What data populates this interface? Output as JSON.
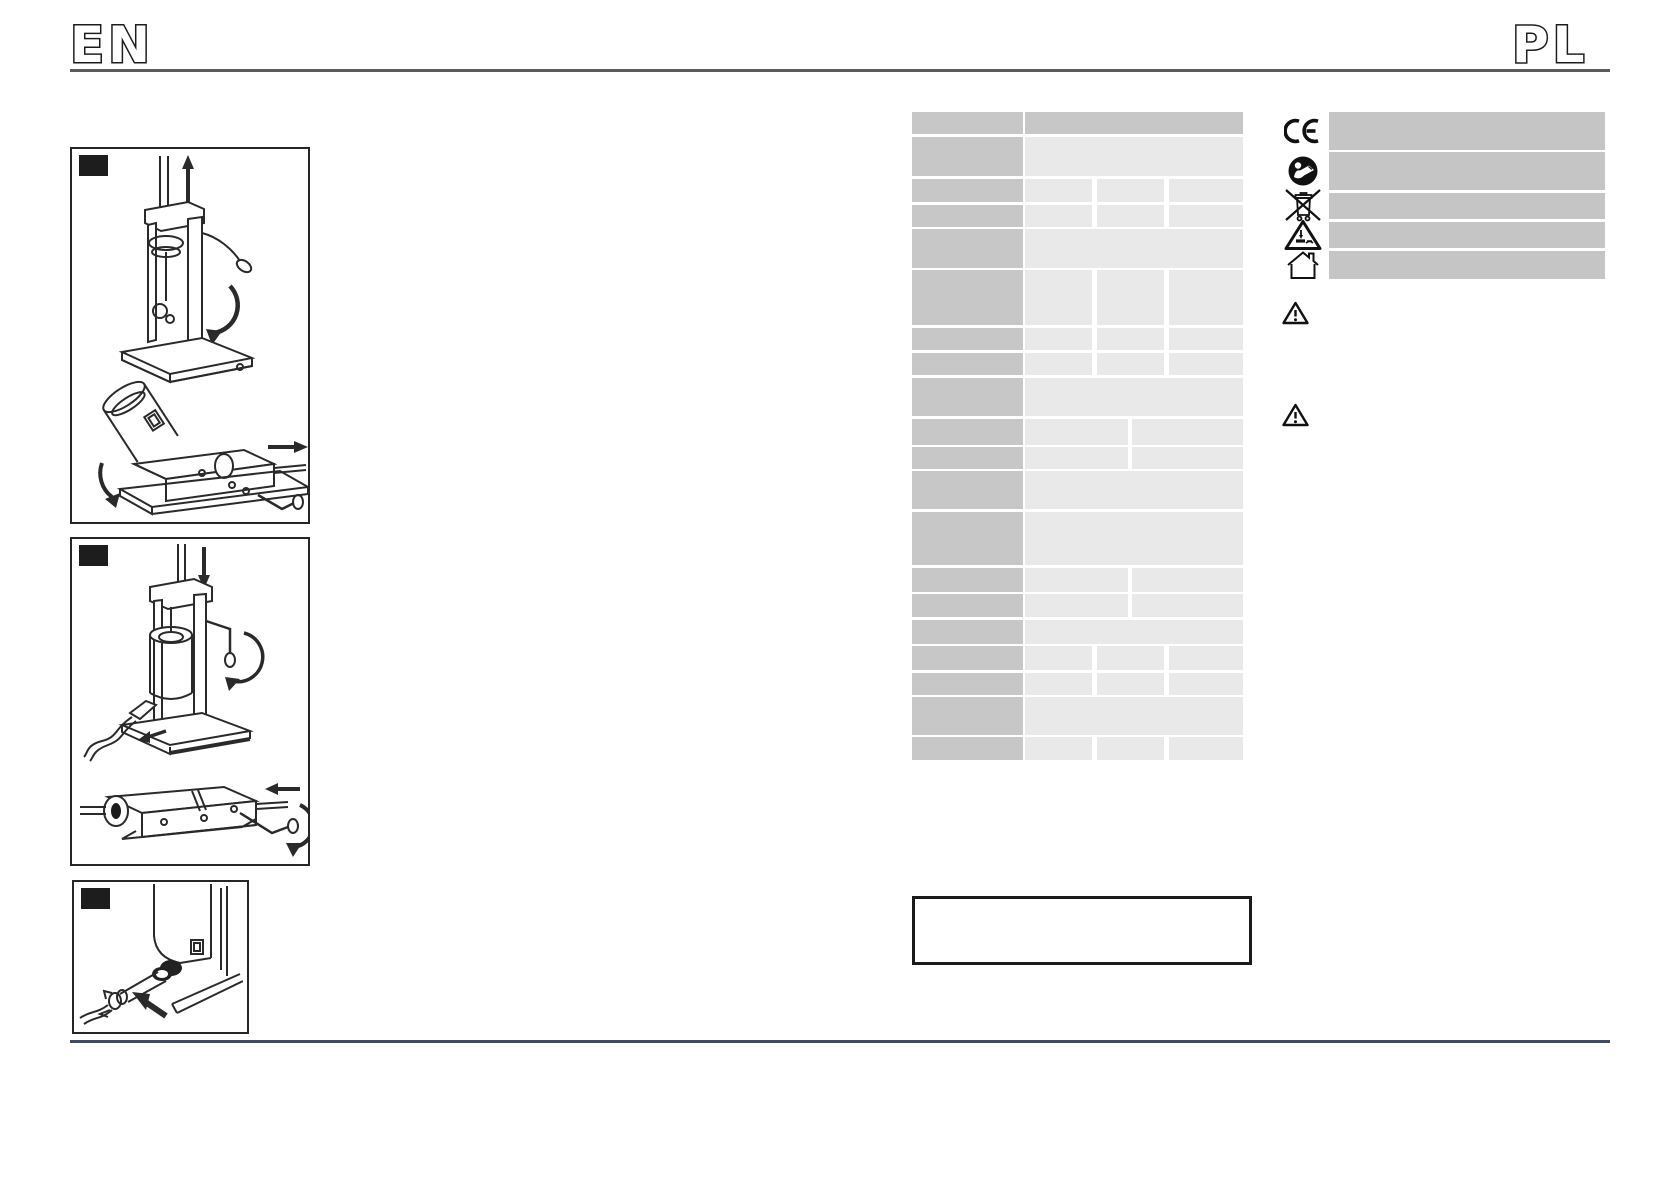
{
  "header": {
    "lang_left": "EN",
    "lang_right": "PL"
  },
  "colors": {
    "table_label_gray": "#c7c7c7",
    "table_value_gray": "#e9e9e9",
    "symbol_bar_gray": "#c5c5c5",
    "rule_top": "#5c5c5c",
    "rule_bottom": "#3e4a66",
    "ink": "#262626",
    "label_square": "#1d1d1d"
  },
  "figures": [
    {
      "name": "figure-vertical-stuffer-assembly",
      "label": "",
      "content": "vertical sausage stuffer with piston raised (up arrow) and tilted cylinder removal from horizontal body (right arrow, crank)"
    },
    {
      "name": "figure-vertical-stuffer-operation",
      "label": "",
      "content": "vertical sausage stuffer with piston pressed down (down arrow, crank rotation) and horizontal stuffer with rod (left arrow, crank rotation)"
    },
    {
      "name": "figure-nozzle-closeup",
      "label": "",
      "content": "close-up of stuffing tube nozzle with casing and arrow"
    }
  ],
  "spec_table": {
    "x": 912,
    "y": 112,
    "width": 331,
    "label_col": {
      "x": 0,
      "w": 111
    },
    "value_area": {
      "x": 113,
      "w": 218
    },
    "col_layouts": {
      "1": [
        {
          "x": 113,
          "w": 218
        }
      ],
      "2": [
        {
          "x": 113,
          "w": 103
        },
        {
          "x": 220,
          "w": 111
        }
      ],
      "3": [
        {
          "x": 113,
          "w": 67
        },
        {
          "x": 185,
          "w": 67
        },
        {
          "x": 257,
          "w": 74
        }
      ]
    },
    "rows": [
      {
        "y": 112,
        "h": 22,
        "cols": 1,
        "header": true,
        "label": "",
        "values": [
          ""
        ]
      },
      {
        "y": 137,
        "h": 39,
        "cols": 1,
        "header": false,
        "label": "",
        "values": [
          ""
        ]
      },
      {
        "y": 179,
        "h": 23,
        "cols": 3,
        "header": false,
        "label": "",
        "values": [
          "",
          "",
          ""
        ]
      },
      {
        "y": 205,
        "h": 22,
        "cols": 3,
        "header": false,
        "label": "",
        "values": [
          "",
          "",
          ""
        ]
      },
      {
        "y": 229,
        "h": 39,
        "cols": 1,
        "header": false,
        "label": "",
        "values": [
          ""
        ]
      },
      {
        "y": 270,
        "h": 55,
        "cols": 3,
        "header": false,
        "label": "",
        "values": [
          "",
          "",
          ""
        ]
      },
      {
        "y": 328,
        "h": 22,
        "cols": 3,
        "header": false,
        "label": "",
        "values": [
          "",
          "",
          ""
        ]
      },
      {
        "y": 353,
        "h": 22,
        "cols": 3,
        "header": false,
        "label": "",
        "values": [
          "",
          "",
          ""
        ]
      },
      {
        "y": 378,
        "h": 38,
        "cols": 1,
        "header": false,
        "label": "",
        "values": [
          ""
        ]
      },
      {
        "y": 419,
        "h": 26,
        "cols": 2,
        "header": false,
        "label": "",
        "values": [
          "",
          ""
        ]
      },
      {
        "y": 447,
        "h": 22,
        "cols": 2,
        "header": false,
        "label": "",
        "values": [
          "",
          ""
        ]
      },
      {
        "y": 471,
        "h": 38,
        "cols": 1,
        "header": false,
        "label": "",
        "values": [
          ""
        ]
      },
      {
        "y": 512,
        "h": 53,
        "cols": 1,
        "header": false,
        "label": "",
        "values": [
          ""
        ]
      },
      {
        "y": 568,
        "h": 24,
        "cols": 2,
        "header": false,
        "label": "",
        "values": [
          "",
          ""
        ]
      },
      {
        "y": 594,
        "h": 23,
        "cols": 2,
        "header": false,
        "label": "",
        "values": [
          "",
          ""
        ]
      },
      {
        "y": 620,
        "h": 24,
        "cols": 1,
        "header": false,
        "label": "",
        "values": [
          ""
        ]
      },
      {
        "y": 646,
        "h": 24,
        "cols": 3,
        "header": false,
        "label": "",
        "values": [
          "",
          "",
          ""
        ]
      },
      {
        "y": 673,
        "h": 22,
        "cols": 3,
        "header": false,
        "label": "",
        "values": [
          "",
          "",
          ""
        ]
      },
      {
        "y": 697,
        "h": 38,
        "cols": 1,
        "header": false,
        "label": "",
        "values": [
          ""
        ]
      },
      {
        "y": 737,
        "h": 23,
        "cols": 3,
        "header": false,
        "label": "",
        "values": [
          "",
          "",
          ""
        ]
      }
    ]
  },
  "symbols": {
    "bar_x": 1329,
    "bar_w": 276,
    "icon_x": 1284,
    "items": [
      {
        "name": "ce-mark-icon",
        "bar_y": 112,
        "bar_h": 38,
        "text": ""
      },
      {
        "name": "read-manual-icon",
        "bar_y": 152,
        "bar_h": 38,
        "text": ""
      },
      {
        "name": "weee-crossed-bin-icon",
        "bar_y": 193,
        "bar_h": 26,
        "text": ""
      },
      {
        "name": "hand-crush-warning-icon",
        "bar_y": 222,
        "bar_h": 26,
        "text": ""
      },
      {
        "name": "indoor-use-house-icon",
        "bar_y": 251,
        "bar_h": 28,
        "text": ""
      }
    ]
  },
  "warning_triangles": [
    {
      "name": "warning-triangle-icon",
      "x": 1276,
      "y": 296
    },
    {
      "name": "warning-triangle-icon",
      "x": 1276,
      "y": 398
    }
  ],
  "note_box": {
    "x": 912,
    "y": 896,
    "w": 334,
    "h": 63,
    "text": ""
  }
}
